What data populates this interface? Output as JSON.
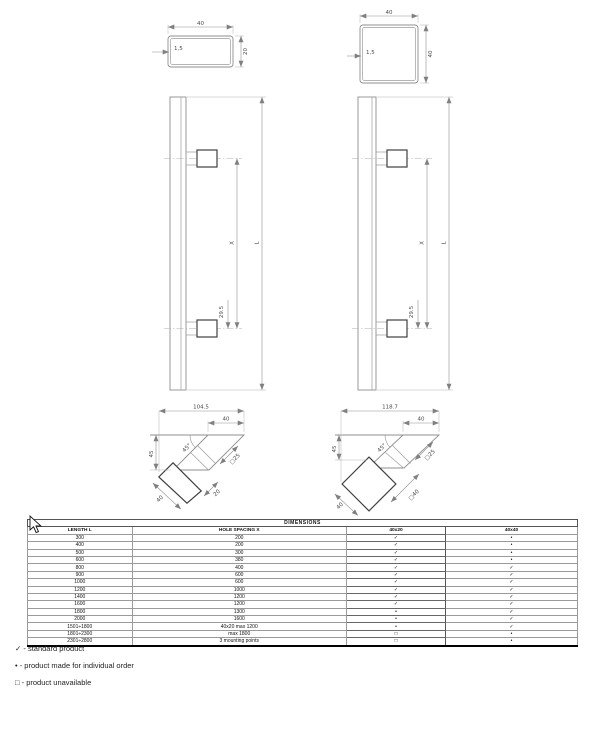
{
  "sections": {
    "rect_tube": {
      "width": "40",
      "height": "20",
      "wall": "1,5"
    },
    "square_tube": {
      "width": "40",
      "height": "40",
      "wall": "1,5"
    }
  },
  "elevations": {
    "left": {
      "length": "L",
      "spacing": "X",
      "offset": "29.5"
    },
    "right": {
      "length": "L",
      "spacing": "X",
      "offset": "29.5"
    }
  },
  "angled": {
    "left": {
      "overall": "104.5",
      "top_width": "40",
      "height": "45",
      "angle": "45°",
      "support": "□25",
      "grip_depth": "20",
      "grip_width": "40"
    },
    "right": {
      "overall": "118.7",
      "top_width": "40",
      "height": "45",
      "angle": "45°",
      "grip": "□40",
      "support": "□25",
      "grip_width": "40"
    }
  },
  "table": {
    "title": "DIMENSIONS",
    "headers": {
      "length": "LENGTH L",
      "spacing": "HOLE SPACING X",
      "col_40x20": "40x20",
      "col_40x40": "40x40"
    },
    "rows": [
      {
        "l": "300",
        "x": "200",
        "c1": "✓",
        "c2": "•"
      },
      {
        "l": "400",
        "x": "200",
        "c1": "✓",
        "c2": "•"
      },
      {
        "l": "500",
        "x": "300",
        "c1": "✓",
        "c2": "•"
      },
      {
        "l": "600",
        "x": "380",
        "c1": "✓",
        "c2": "•"
      },
      {
        "l": "800",
        "x": "400",
        "c1": "✓",
        "c2": "✓"
      },
      {
        "l": "900",
        "x": "600",
        "c1": "✓",
        "c2": "✓"
      },
      {
        "l": "1000",
        "x": "600",
        "c1": "✓",
        "c2": "✓"
      },
      {
        "l": "1200",
        "x": "1000",
        "c1": "✓",
        "c2": "✓"
      },
      {
        "l": "1400",
        "x": "1200",
        "c1": "✓",
        "c2": "✓"
      },
      {
        "l": "1600",
        "x": "1200",
        "c1": "✓",
        "c2": "✓"
      },
      {
        "l": "1800",
        "x": "1300",
        "c1": "•",
        "c2": "✓"
      },
      {
        "l": "2000",
        "x": "1600",
        "c1": "•",
        "c2": "✓"
      },
      {
        "l": "1501÷1800",
        "x": "40x20 max 1200",
        "c1": "•",
        "c2": "✓"
      },
      {
        "l": "1801÷2300",
        "x": "max 1800",
        "c1": "□",
        "c2": "•"
      },
      {
        "l": "2301÷2800",
        "x": "3 mounting points",
        "c1": "□",
        "c2": "•"
      }
    ]
  },
  "legend": {
    "items": [
      "✓ - standard product",
      "• - product made for individual order",
      "□ - product unavailable"
    ]
  }
}
